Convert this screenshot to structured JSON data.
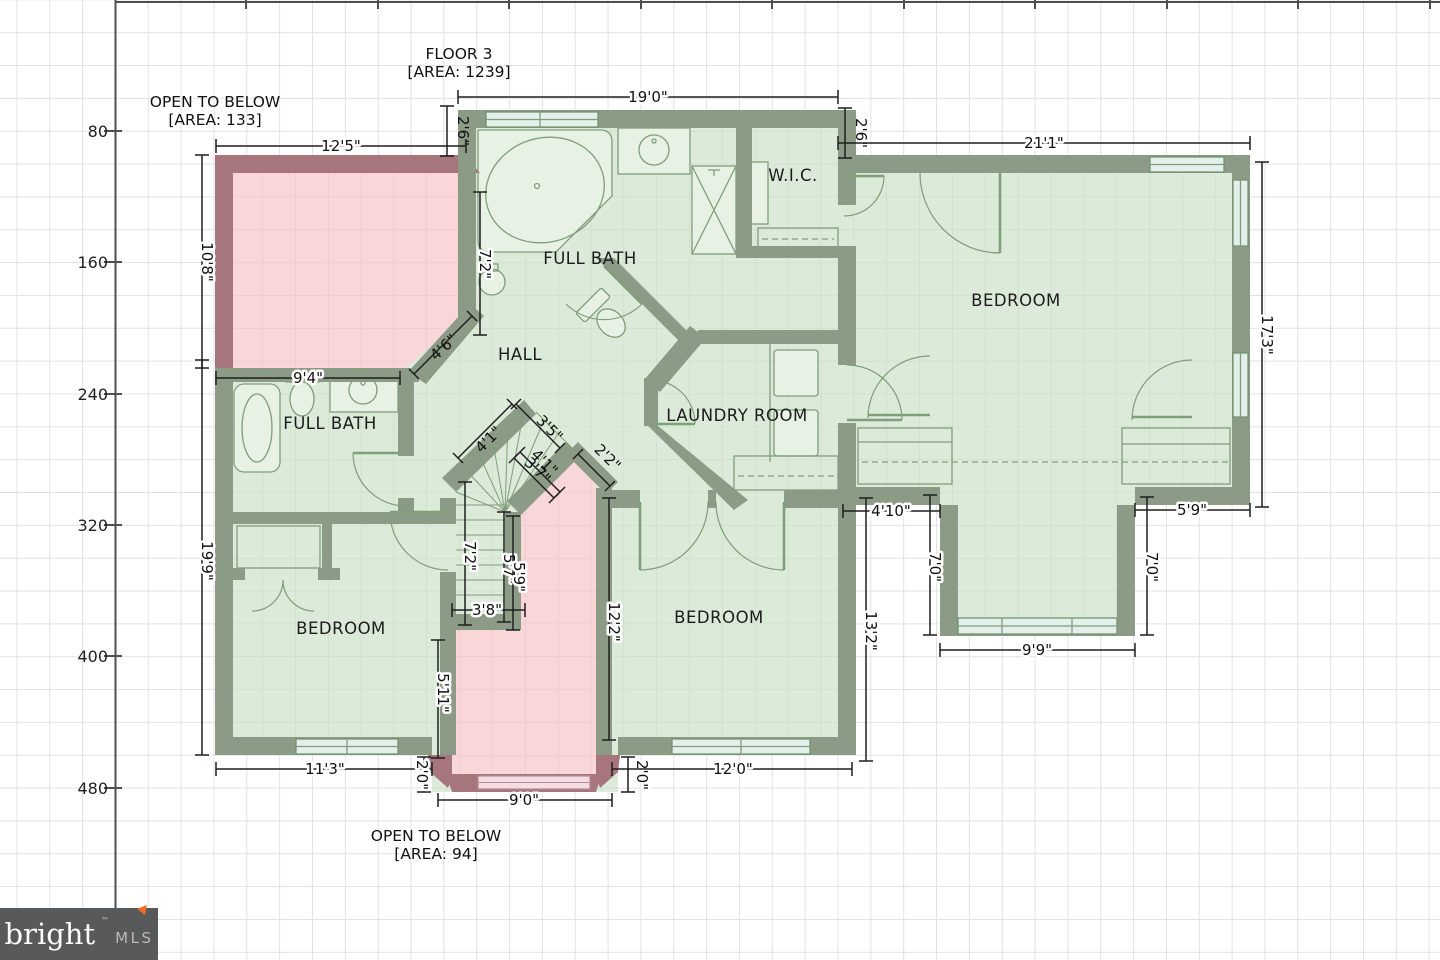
{
  "title": {
    "line1": "FLOOR 3",
    "line2": "[AREA: 1239]"
  },
  "annotations": {
    "open_below_top": {
      "line1": "OPEN TO BELOW",
      "line2": "[AREA: 133]"
    },
    "open_below_bottom": {
      "line1": "OPEN TO BELOW",
      "line2": "[AREA: 94]"
    }
  },
  "rooms": {
    "full_bath_top": "FULL BATH",
    "wic": "W.I.C.",
    "bedroom_right": "BEDROOM",
    "hall": "HALL",
    "full_bath_left": "FULL BATH",
    "laundry": "LAUNDRY ROOM",
    "bedroom_left": "BEDROOM",
    "bedroom_mid": "BEDROOM"
  },
  "dims": [
    "19'0\"",
    "2'6\"",
    "2'6\"",
    "21'1\"",
    "12'5\"",
    "10'8\"",
    "17'3\"",
    "7'2\"",
    "4'6\"",
    "9'4\"",
    "4'1\"",
    "3'5\"",
    "4'1\"",
    "3'7\"",
    "2'2\"",
    "7'2\"",
    "5'7\"",
    "5'9\"",
    "3'8\"",
    "5'11\"",
    "19'9\"",
    "11'3\"",
    "2'0\"",
    "9'0\"",
    "2'0\"",
    "12'0\"",
    "12'2\"",
    "13'2\"",
    "4'10\"",
    "7'0\"",
    "9'9\"",
    "7'0\"",
    "5'9\""
  ],
  "axis": {
    "y_ticks": [
      "80",
      "160",
      "240",
      "320",
      "400",
      "480"
    ]
  },
  "logo": {
    "brand": "bright",
    "tm": "™",
    "suffix": "MLS"
  },
  "colors": {
    "wall": "#8b9b85",
    "open_below_wall": "#a7767d",
    "room_fill": "#dcead9",
    "open_below_fill": "#f9d6d8",
    "window": "#e2efeb",
    "dimension": "#1f1f1f",
    "grid": "#e2e2e2",
    "logo_bg": "#58595b",
    "logo_accent": "#f26c24"
  }
}
